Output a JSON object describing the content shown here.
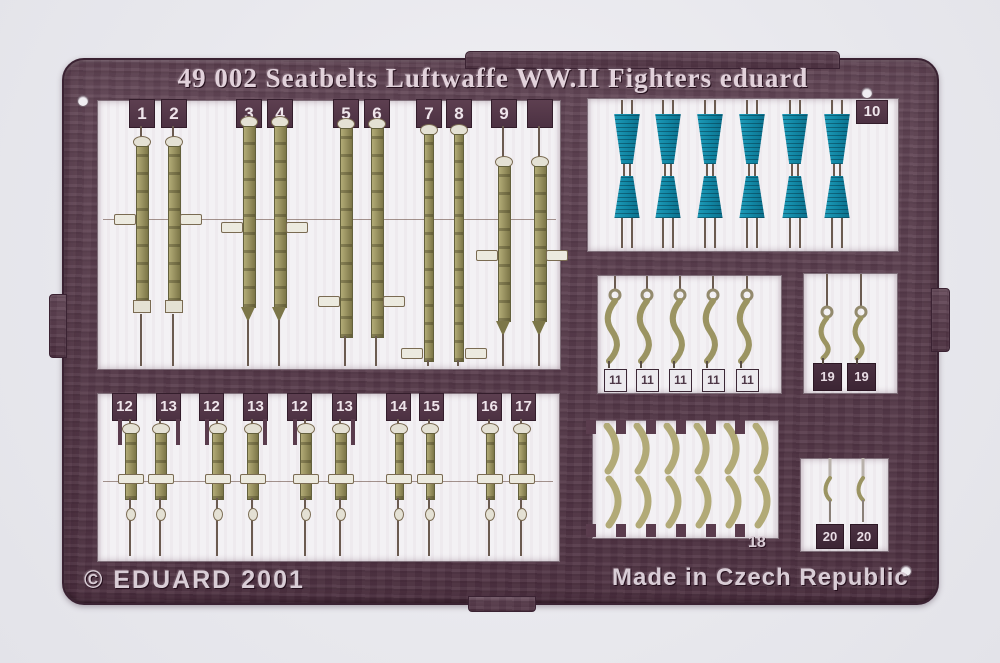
{
  "sheet": {
    "title": "49 002 Seatbelts Luftwaffe WW.II Fighters eduard",
    "copyright_text": "© EDUARD 2001",
    "origin_text": "Made in Czech Republic"
  },
  "part_labels": {
    "row1": [
      "1",
      "2",
      "3",
      "4",
      "5",
      "6",
      "7",
      "8",
      "9",
      ""
    ],
    "blue_panel": "10",
    "hooks_panel": [
      "11",
      "11",
      "11",
      "11",
      "11"
    ],
    "right_hooks": [
      "19",
      "19"
    ],
    "row2": [
      "12",
      "13",
      "12",
      "13",
      "12",
      "13",
      "14",
      "15",
      "16",
      "17"
    ],
    "curves_panel": "18",
    "bottom_right_hooks": [
      "20",
      "20"
    ]
  },
  "colors": {
    "fret_maroon": "#5a3c4d",
    "panel_white": "#f3f1f4",
    "strap_olive": "#9b9462",
    "buckle_teal": "#1187a5",
    "paper_background": "#e8e8ed",
    "tag_text": "#efe5eb"
  }
}
